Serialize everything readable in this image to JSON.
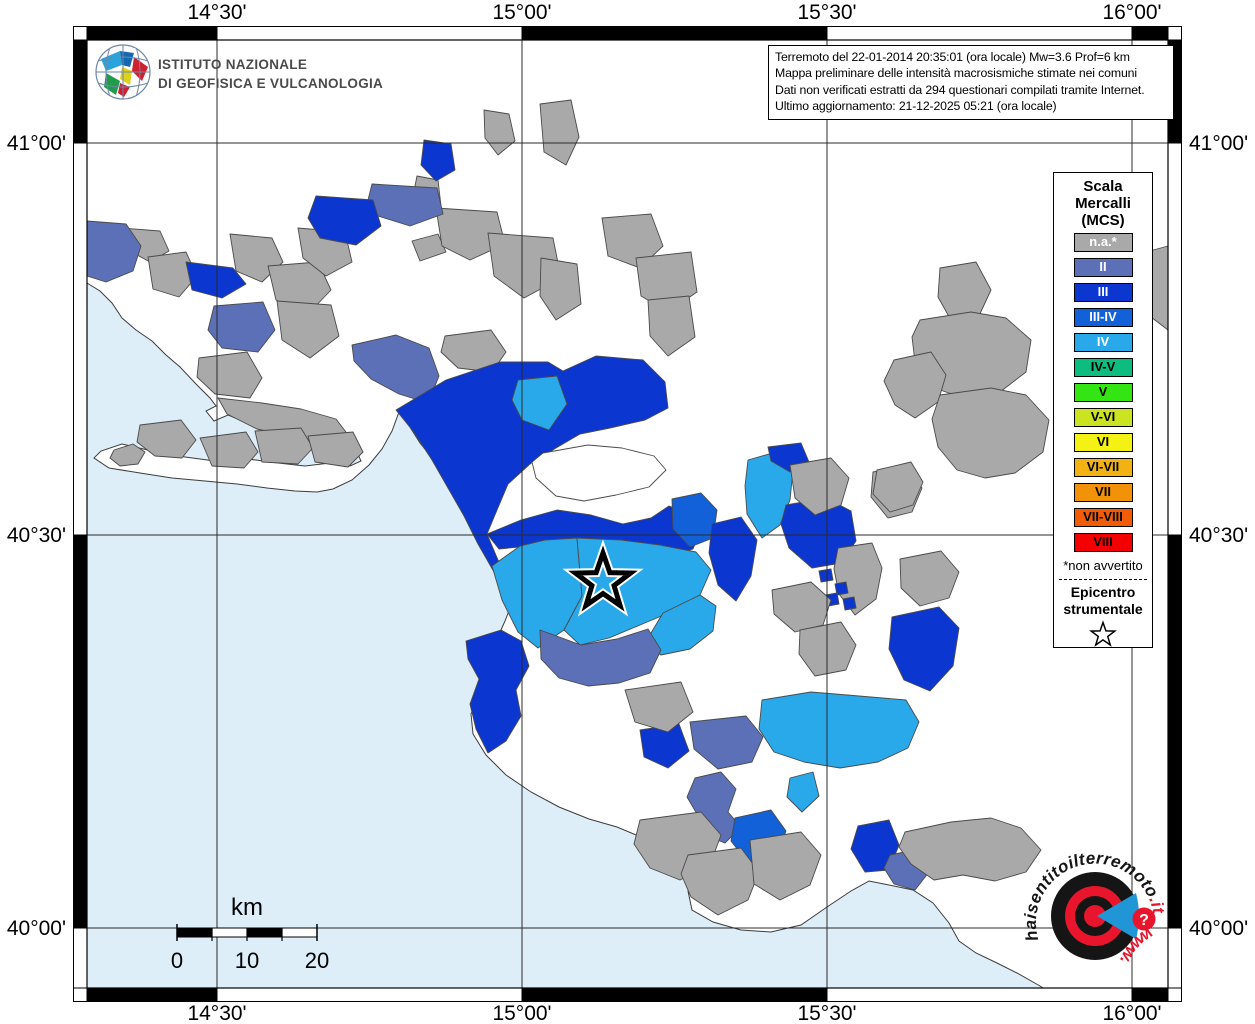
{
  "axis": {
    "top": [
      "14°30'",
      "15°00'",
      "15°30'",
      "16°00'"
    ],
    "bottom": [
      "14°30'",
      "15°00'",
      "15°30'",
      "16°00'"
    ],
    "left": [
      "41°00'",
      "40°30'",
      "40°00'"
    ],
    "right": [
      "41°00'",
      "40°30'",
      "40°00'"
    ]
  },
  "info_box": {
    "lines": [
      "Terremoto del 22-01-2014 20:35:01 (ora locale) Mw=3.6 Prof=6 km",
      "Mappa preliminare delle intensità macrosismiche stimate nei comuni",
      "Dati non verificati estratti da 294 questionari compilati tramite Internet.",
      "Ultimo aggiornamento: 21-12-2025 05:21 (ora locale)"
    ]
  },
  "ingv": {
    "line1": "ISTITUTO NAZIONALE",
    "line2": "DI GEOFISICA E VULCANOLOGIA"
  },
  "legend": {
    "title_lines": [
      "Scala",
      "Mercalli",
      "(MCS)"
    ],
    "swatches": [
      {
        "label": "n.a.*",
        "color": "#a9a9a9",
        "text": "#ffffff"
      },
      {
        "label": "II",
        "color": "#5b70b7",
        "text": "#ffffff"
      },
      {
        "label": "III",
        "color": "#0b36cf",
        "text": "#ffffff"
      },
      {
        "label": "III-IV",
        "color": "#1261d8",
        "text": "#ffffff"
      },
      {
        "label": "IV",
        "color": "#29a9e9",
        "text": "#ffffff"
      },
      {
        "label": "IV-V",
        "color": "#0dbd7e",
        "text": "#000000"
      },
      {
        "label": "V",
        "color": "#33e513",
        "text": "#000000"
      },
      {
        "label": "V-VI",
        "color": "#cbe422",
        "text": "#000000"
      },
      {
        "label": "VI",
        "color": "#f4f114",
        "text": "#000000"
      },
      {
        "label": "VI-VII",
        "color": "#f3b214",
        "text": "#000000"
      },
      {
        "label": "VII",
        "color": "#f29208",
        "text": "#000000"
      },
      {
        "label": "VII-VIII",
        "color": "#f25c07",
        "text": "#000000"
      },
      {
        "label": "VIII",
        "color": "#f40000",
        "text": "#000000"
      }
    ],
    "footnote": "*non avvertito",
    "epicenter_label_lines": [
      "Epicentro",
      "strumentale"
    ]
  },
  "scalebar": {
    "unit": "km",
    "ticks": [
      "0",
      "10",
      "20"
    ]
  },
  "watermark": {
    "arc_main": "haisentitoilterremoto",
    "arc_suffix": ".it",
    "www": "www.",
    "question_mark": "?",
    "red": "#e8152c",
    "blue": "#2196d6"
  },
  "map": {
    "sea_color": "#ddeef9",
    "land_color": "#ffffff",
    "epicenter": {
      "x": 603,
      "y": 582
    },
    "class_colors": {
      "na": "#a9a9a9",
      "II": "#5b70b7",
      "III": "#0b36cf",
      "III-IV": "#1261d8",
      "IV": "#29a9e9",
      "land": "#ffffff"
    },
    "sea_path": "M 87 283 L 100 291 L 112 303 L 122 318 L 136 330 L 152 341 L 166 355 L 180 367 L 196 384 L 210 398 L 216 406 L 206 411 L 214 421 L 228 415 L 243 421 L 257 428 L 269 424 L 284 430 L 299 427 L 317 432 L 331 439 L 345 448 L 357 452 L 361 461 L 350 466 L 330 463 L 305 466 L 278 463 L 248 459 L 215 461 L 185 457 L 152 451 L 122 444 L 101 451 L 94 458 L 109 468 L 140 473 L 172 478 L 205 481 L 237 484 L 267 488 L 295 491 L 317 492 L 333 489 L 352 480 L 369 465 L 382 449 L 392 431 L 399 412 L 408 424 L 420 443 L 433 459 L 446 474 L 455 490 L 464 507 L 472 524 L 480 541 L 488 559 L 497 577 L 506 592 L 512 603 L 505 621 L 497 639 L 505 657 L 492 676 L 479 695 L 471 714 L 473 734 L 486 755 L 506 775 L 531 792 L 559 807 L 589 819 L 617 827 L 641 837 L 659 847 L 673 853 L 690 866 L 700 876 L 688 891 L 692 910 L 713 922 L 741 930 L 771 932 L 801 925 L 827 907 L 851 891 L 869 881 L 889 885 L 913 890 L 933 903 L 949 923 L 959 941 L 976 953 L 997 963 L 1017 973 L 1040 986 L 1043 988 L 87 988 Z",
    "municipalities": [
      {
        "c": "na",
        "p": "122,228 160,231 169,251 150,262 128,250"
      },
      {
        "c": "na",
        "p": "148,257 186,252 197,276 179,297 153,289"
      },
      {
        "c": "na",
        "p": "230,234 272,238 283,262 262,282 236,271"
      },
      {
        "c": "na",
        "p": "268,266 318,262 331,290 308,314 276,300"
      },
      {
        "c": "na",
        "p": "298,228 345,232 352,262 326,276 303,258"
      },
      {
        "c": "na",
        "p": "277,301 331,305 339,336 310,358 282,340"
      },
      {
        "c": "na",
        "p": "199,358 247,352 262,378 250,398 215,394 197,377"
      },
      {
        "c": "na",
        "p": "218,398 262,403 301,409 336,419 352,440 329,444 294,437 257,429 227,414"
      },
      {
        "c": "na",
        "p": "140,425 181,420 196,440 182,458 155,456 137,442"
      },
      {
        "c": "na",
        "p": "200,438 246,432 258,452 244,468 212,466"
      },
      {
        "c": "na",
        "p": "255,431 301,428 313,448 298,464 262,462"
      },
      {
        "c": "na",
        "p": "308,436 353,432 363,452 348,467 315,462"
      },
      {
        "c": "na",
        "p": "417,176 438,180 441,206 424,212 413,196"
      },
      {
        "c": "na",
        "p": "412,241 438,234 446,252 420,261"
      },
      {
        "c": "na",
        "p": "436,208 497,212 505,244 470,260 442,246"
      },
      {
        "c": "na",
        "p": "488,233 553,238 561,278 524,298 494,276"
      },
      {
        "c": "na",
        "p": "541,258 577,264 581,304 556,320 540,296"
      },
      {
        "c": "na",
        "p": "484,110 509,114 515,141 498,155 485,138"
      },
      {
        "c": "na",
        "p": "540,104 571,100 579,137 566,165 544,152"
      },
      {
        "c": "na",
        "p": "602,218 651,214 663,246 640,268 608,256"
      },
      {
        "c": "na",
        "p": "636,258 691,252 697,292 668,312 641,296"
      },
      {
        "c": "na",
        "p": "648,300 689,296 695,337 668,356 650,336"
      },
      {
        "c": "na",
        "p": "445,336 491,330 506,352 492,372 458,368 441,352"
      },
      {
        "c": "II",
        "p": "87,221 126,224 141,246 133,271 106,282 87,276"
      },
      {
        "c": "II",
        "p": "214,306 263,302 275,330 258,352 222,348 208,330"
      },
      {
        "c": "II",
        "p": "372,184 437,188 443,214 410,226 378,216 368,200"
      },
      {
        "c": "II",
        "p": "352,345 396,335 429,348 439,376 428,403 399,394 371,379 354,361"
      },
      {
        "c": "III",
        "p": "186,262 233,268 246,284 222,298 192,290"
      },
      {
        "c": "III",
        "p": "316,196 373,200 381,226 356,245 320,238 308,218"
      },
      {
        "c": "III",
        "p": "424,140 451,144 455,170 436,181 421,165"
      },
      {
        "c": "III",
        "p": "396,410 446,380 500,362 548,362 563,371 596,356 643,360 665,382 668,408 645,420 610,428 580,434 556,448 530,464 508,484 497,510 487,534 498,560 511,582 514,601 494,572 478,544 464,516 448,488 432,460 413,431"
      },
      {
        "c": "IV",
        "p": "518,380 557,376 567,404 549,430 522,420 512,400"
      },
      {
        "c": "land",
        "p": "543,453 588,445 622,448 654,456 666,470 649,487 616,495 584,501 556,496 536,478 532,462"
      },
      {
        "c": "III",
        "p": "487,534 521,520 557,510 591,515 623,524 651,518 669,506 687,513 701,529 693,549 668,557 640,561 610,557 579,553 549,549 519,547 499,549"
      },
      {
        "c": "IV",
        "p": "492,566 520,546 545,540 577,538 582,596 564,630 538,648 518,632 502,600"
      },
      {
        "c": "IV",
        "p": "577,538 621,540 660,545 696,552 711,570 700,595 671,612 640,625 609,638 580,645 564,630 582,596"
      },
      {
        "c": "IV",
        "p": "663,613 700,595 716,606 713,631 690,649 661,655 645,643"
      },
      {
        "c": "II",
        "p": "540,630 581,645 617,639 648,629 661,650 650,673 619,683 588,686 559,678 541,659"
      },
      {
        "c": "III",
        "p": "466,641 501,630 521,641 529,666 516,690 521,716 506,741 488,753 476,729 470,704 479,679 468,659"
      },
      {
        "c": "III",
        "p": "640,730 679,724 689,751 668,768 644,757"
      },
      {
        "c": "III-IV",
        "p": "672,499 701,493 717,510 713,538 690,547 673,529"
      },
      {
        "c": "III",
        "p": "712,524 741,517 757,540 751,576 736,601 718,585 709,553"
      },
      {
        "c": "IV",
        "p": "748,460 776,452 793,470 790,500 780,525 762,538 747,514 745,486"
      },
      {
        "c": "III",
        "p": "768,447 801,443 809,462 790,472 771,461"
      },
      {
        "c": "III",
        "p": "786,505 826,498 851,511 856,541 841,563 812,568 789,548 781,524"
      },
      {
        "c": "na",
        "p": "790,465 831,458 849,478 841,505 815,515 795,498"
      },
      {
        "c": "na",
        "p": "873,472 908,465 922,488 912,512 888,518 871,497"
      },
      {
        "c": "na",
        "p": "838,548 872,543 882,568 876,599 855,615 839,594 834,569"
      },
      {
        "c": "na",
        "p": "900,559 941,551 959,572 949,598 920,606 901,588"
      },
      {
        "c": "III",
        "p": "892,617 939,607 959,628 953,666 930,691 904,680 889,649"
      },
      {
        "c": "III",
        "p": "819,571 831,569 833,580 821,582"
      },
      {
        "c": "III",
        "p": "835,584 846,582 848,593 837,595"
      },
      {
        "c": "III",
        "p": "826,595 837,593 839,604 828,606"
      },
      {
        "c": "III",
        "p": "843,599 854,597 856,608 845,610"
      },
      {
        "c": "na",
        "p": "772,590 811,582 831,600 823,625 795,632 774,614"
      },
      {
        "c": "na",
        "p": "800,630 841,622 856,645 846,670 815,676 799,654"
      },
      {
        "c": "na",
        "p": "625,690 681,682 693,712 668,732 635,722"
      },
      {
        "c": "II",
        "p": "690,722 746,716 763,737 752,762 718,769 694,749"
      },
      {
        "c": "IV",
        "p": "762,700 811,692 859,696 906,700 919,722 908,748 878,762 840,768 804,762 774,752 759,729"
      },
      {
        "c": "II",
        "p": "695,778 721,772 736,789 728,812 741,827 725,843 704,835 697,814 687,797"
      },
      {
        "c": "IV",
        "p": "790,778 813,772 819,796 802,812 787,797"
      },
      {
        "c": "III-IV",
        "p": "735,818 771,810 786,831 776,856 748,863 731,841"
      },
      {
        "c": "na",
        "p": "640,820 701,812 721,835 710,865 680,880 650,868 634,844"
      },
      {
        "c": "na",
        "p": "688,855 741,848 759,872 748,900 718,915 691,897 681,874"
      },
      {
        "c": "na",
        "p": "750,840 801,832 821,855 810,885 780,900 754,884"
      },
      {
        "c": "III",
        "p": "858,826 889,820 899,845 889,870 865,872 851,849"
      },
      {
        "c": "II",
        "p": "890,855 919,849 929,872 915,890 894,884 884,868"
      },
      {
        "c": "na",
        "p": "905,832 951,822 991,818 1021,828 1041,850 1026,872 995,881 963,875 934,880 911,864 899,847"
      },
      {
        "c": "na",
        "p": "940,268 976,262 991,290 978,318 952,322 938,297"
      },
      {
        "c": "na",
        "p": "920,320 971,312 1006,318 1031,340 1026,372 1000,392 964,398 934,388 915,362 912,337"
      },
      {
        "c": "na",
        "p": "894,360 931,352 946,375 938,402 915,418 895,405 884,381"
      },
      {
        "c": "na",
        "p": "940,395 991,388 1026,395 1049,420 1043,452 1015,473 985,478 957,470 938,447 932,419"
      },
      {
        "c": "na",
        "p": "877,470 911,462 923,482 913,505 890,512 873,494"
      },
      {
        "c": "na",
        "p": "114,450 133,444 145,452 138,464 120,466 110,458"
      },
      {
        "c": "na",
        "p": "1146,252 1168,246 1168,330 1147,314 1139,284"
      }
    ]
  }
}
